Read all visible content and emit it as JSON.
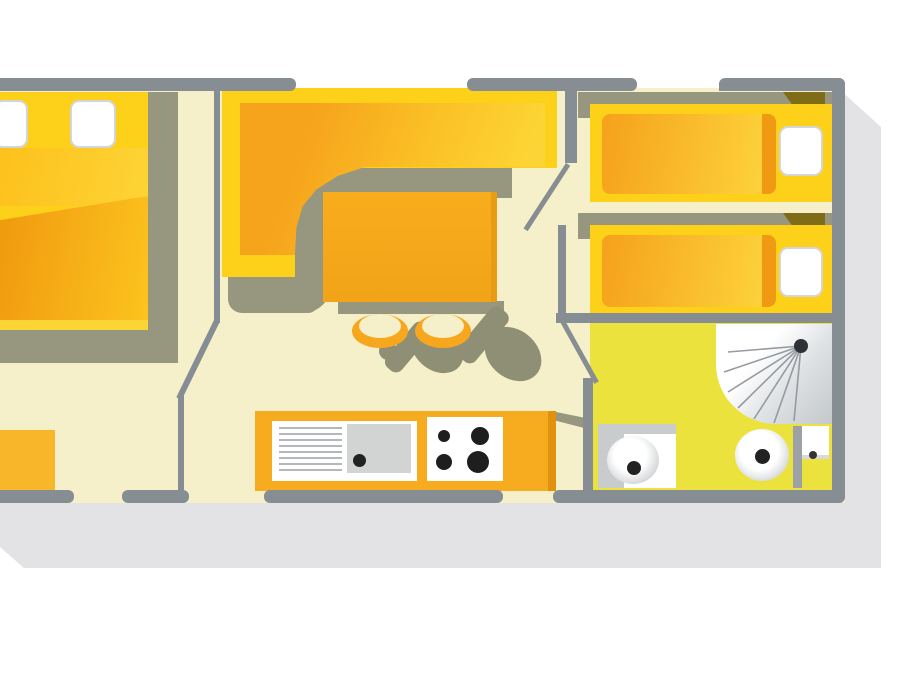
{
  "figure": {
    "kind": "floor-plan",
    "subject": "mobile-home layout, top-down illustrated view, no text labels"
  },
  "palette": {
    "background": "#ffffff",
    "page_shadow": "#e3e3e5",
    "wall": "#868d93",
    "floor": "#f5f0c9",
    "bathroom_floor": "#ebe23e",
    "furniture_yellow": "#fdd019",
    "furniture_orange": "#f6a71d",
    "shadow_olive": "#97977f",
    "shadow_olive_dark": "#8e8f75",
    "corner_shadow_brown": "#7e6c16",
    "fixture_white": "#ffffff",
    "fixture_gray": "#c9cccd",
    "appliance_dark": "#1e1e1e"
  },
  "rooms": [
    {
      "name": "master-bedroom",
      "fixtures": [
        "double-bed",
        "two-pillows",
        "nightstand"
      ]
    },
    {
      "name": "living-area",
      "fixtures": [
        "corner-sofa",
        "dining-table",
        "two-chairs"
      ]
    },
    {
      "name": "kitchen",
      "fixtures": [
        "counter",
        "drainer",
        "sink",
        "hob-four-burners"
      ]
    },
    {
      "name": "twin-bedroom",
      "fixtures": [
        "single-bed",
        "single-bed",
        "two-pillows"
      ]
    },
    {
      "name": "bathroom",
      "fixtures": [
        "shower",
        "washbasin",
        "toilet",
        "cistern"
      ]
    }
  ]
}
